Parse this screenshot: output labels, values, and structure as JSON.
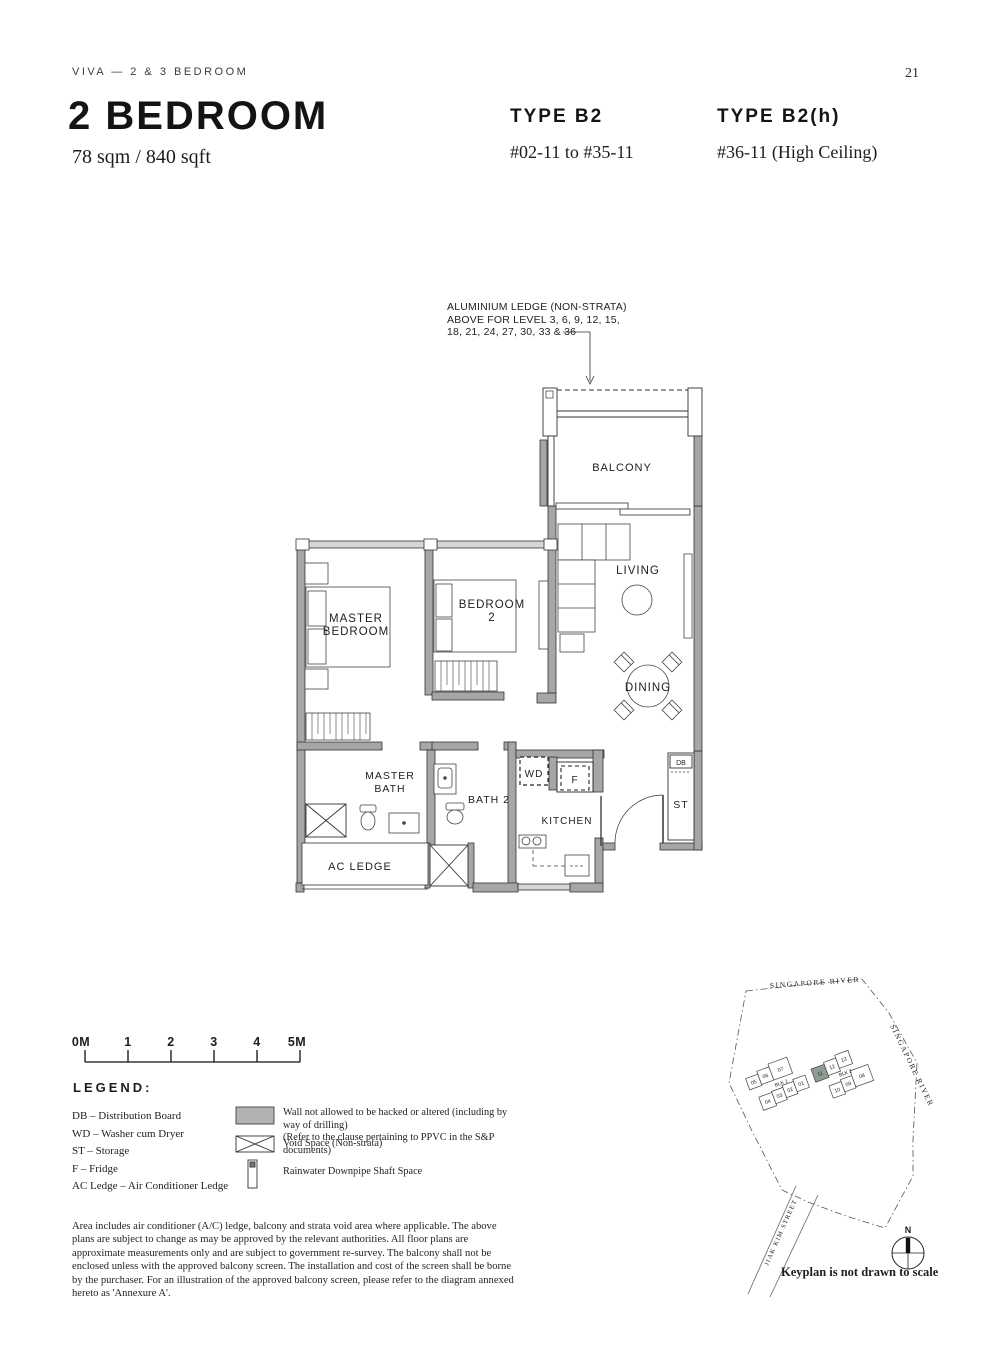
{
  "header": {
    "doc_label": "VIVA — 2 & 3 BEDROOM",
    "page_number": "21"
  },
  "title": {
    "main": "2 BEDROOM",
    "area": "78 sqm / 840 sqft"
  },
  "types": [
    {
      "name": "TYPE B2",
      "units": "#02-11 to #35-11"
    },
    {
      "name": "TYPE B2(h)",
      "units": "#36-11 (High Ceiling)"
    }
  ],
  "floorplan": {
    "annotation": {
      "line1": "ALUMINIUM LEDGE (NON-STRATA)",
      "line2": "ABOVE FOR LEVEL 3, 6, 9, 12, 15,",
      "line3": "18, 21, 24, 27, 30, 33 & 36"
    },
    "rooms": {
      "balcony": "BALCONY",
      "living": "LIVING",
      "dining": "DINING",
      "master_bedroom1": "MASTER",
      "master_bedroom2": "BEDROOM",
      "bedroom2_1": "BEDROOM",
      "bedroom2_2": "2",
      "master_bath1": "MASTER",
      "master_bath2": "BATH",
      "bath2": "BATH 2",
      "kitchen": "KITCHEN",
      "ac_ledge": "AC LEDGE",
      "wd": "WD",
      "fridge": "F",
      "storage": "ST",
      "db": "DB"
    },
    "wall_color": "#a6a6a6",
    "window_color": "#d6d6d6"
  },
  "scalebar": {
    "labels": [
      "0M",
      "1",
      "2",
      "3",
      "4",
      "5M"
    ]
  },
  "legend": {
    "heading": "LEGEND:",
    "abbreviations": [
      "DB – Distribution Board",
      "WD – Washer cum Dryer",
      "ST – Storage",
      "F – Fridge",
      "AC Ledge – Air Conditioner Ledge"
    ],
    "symbols": {
      "wall_line1": "Wall not allowed to be hacked or altered (including by way of drilling)",
      "wall_line2": "(Refer to the clause pertaining to PPVC in the S&P documents)",
      "void": "Void Space (Non-strata)",
      "rain": "Rainwater Downpipe Shaft Space",
      "wall_swatch_color": "#b2b2b2"
    }
  },
  "disclaimer": "Area includes air conditioner (A/C) ledge, balcony and strata void area where applicable. The above plans are subject to change as may be approved by the relevant authorities. All floor plans are approximate measurements only and are subject to government re-survey. The balcony shall not be enclosed unless with the approved balcony screen. The installation and cost of the screen shall be borne by the purchaser. For an illustration of the approved balcony screen, please refer to the diagram annexed hereto as 'Annexure A'.",
  "keyplan": {
    "river_top": "SINGAPORE RIVER",
    "river_right": "SINGAPORE RIVER",
    "street": "JIAK KIM STREET",
    "blk1_label": "BLK 1",
    "blk2_label": "BLK 2",
    "blk1_units_top": [
      "05",
      "06",
      "07"
    ],
    "blk1_units_bottom": [
      "04",
      "03",
      "02",
      "01"
    ],
    "blk2_units_top": [
      "11",
      "12",
      "13"
    ],
    "blk2_units_bottom": [
      "10",
      "09",
      "08"
    ],
    "highlighted_unit": "11",
    "highlight_color": "#8d9d94",
    "compass_n": "N",
    "note": "Keyplan is not drawn to scale"
  }
}
